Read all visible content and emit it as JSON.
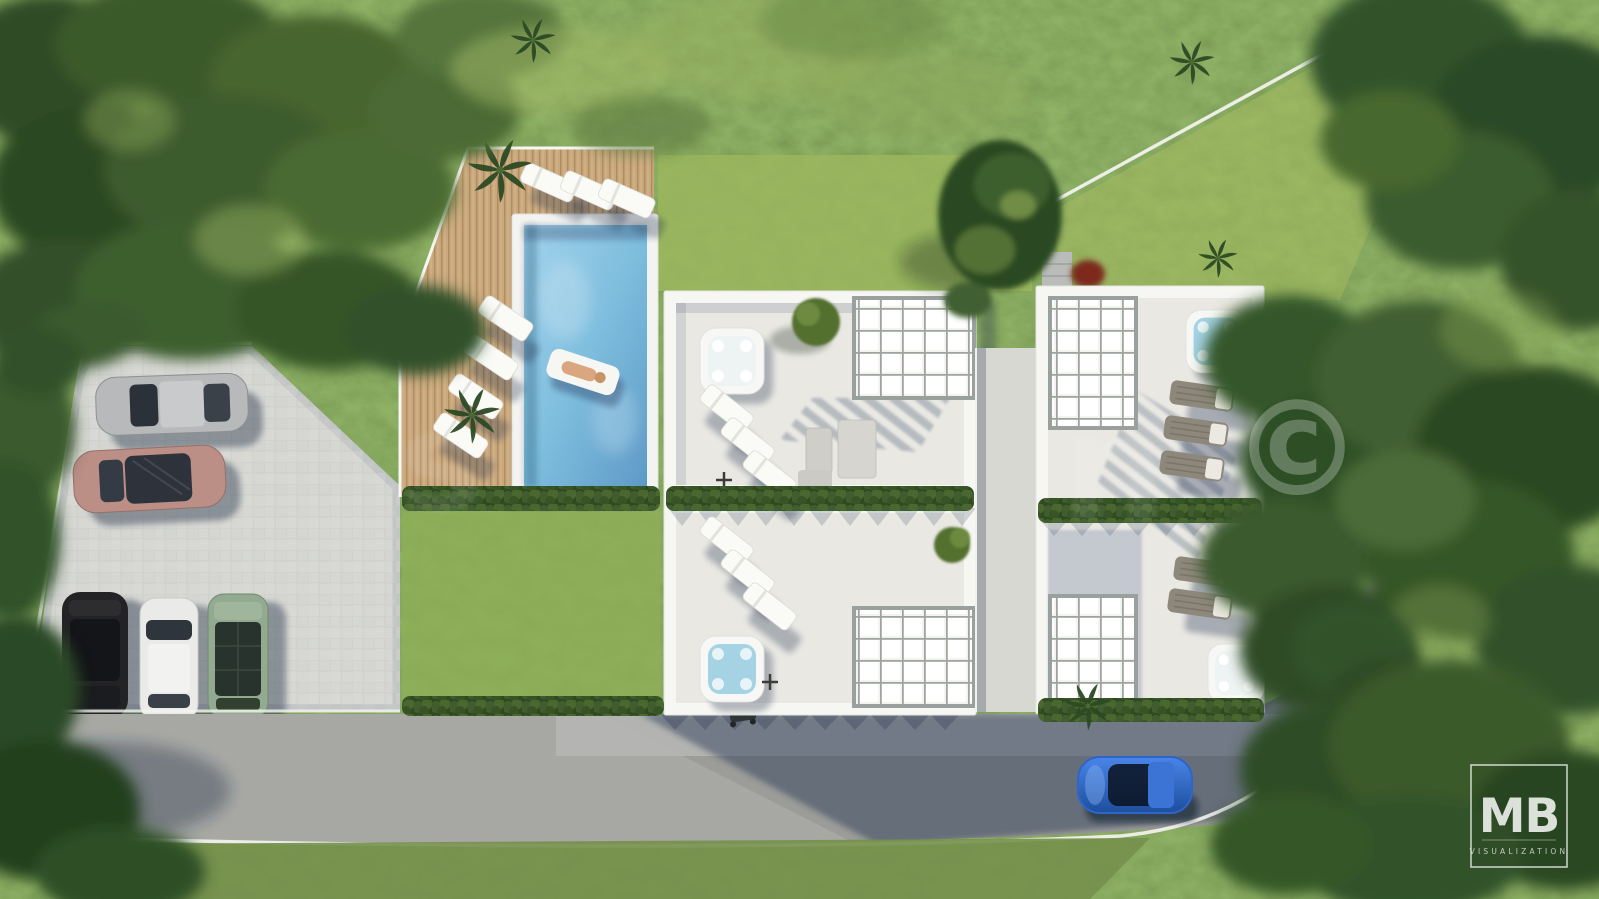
{
  "scene": {
    "type": "aerial-architectural-render",
    "description": "Top-down 3D visualization of a modern two-block villa development with four rooftop terraces, pergolas, jacuzzis, a swimming pool with sun deck, a paved parking lot with five cars, lawns, a perimeter-walled plot and a curved asphalt access road surrounded by trees",
    "watermark": {
      "symbol": "©",
      "faint_letter_left": "s",
      "faint_letter_right": "n"
    },
    "logo": {
      "initials": "MB",
      "subtitle": "VISUALIZATION"
    }
  },
  "objects": {
    "parking_cars": [
      "silver sedan",
      "rose sedan",
      "black suv",
      "white hatchback",
      "green suv"
    ],
    "road_car": "blue sedan",
    "pool": "rectangular pool with person on white float",
    "rooftop_terraces": 4,
    "jacuzzis": 4,
    "pergolas": 4,
    "white_loungers": 13,
    "dark_loungers": 5
  },
  "colors": {
    "grass_base": "#75904c",
    "lawn": "#9cb85e",
    "lawn_below_deck": "#8fae57",
    "plot_grass": "#a6bb60",
    "pool_water": "#7fbede",
    "pool_coping": "#f3f4f1",
    "parapet": "#f6f6f2",
    "terrace_floor": "#e9e8e3",
    "core_gray": "#d8d8d3",
    "paver": "#d7d8d4",
    "road": "#9a9b97",
    "road_apron": "#b5b6b2",
    "curb": "#f3f3ef",
    "car_silver": "#b7b9bb",
    "car_rose": "#bb8e86",
    "car_black": "#232325",
    "car_white": "#eaeae8",
    "car_green": "#92aa8f",
    "car_blue": "#2d66c8",
    "jacuzzi_water": "#a5d3e4",
    "hedge_green": "#33501f",
    "wood_deck": "#c9a87e"
  }
}
